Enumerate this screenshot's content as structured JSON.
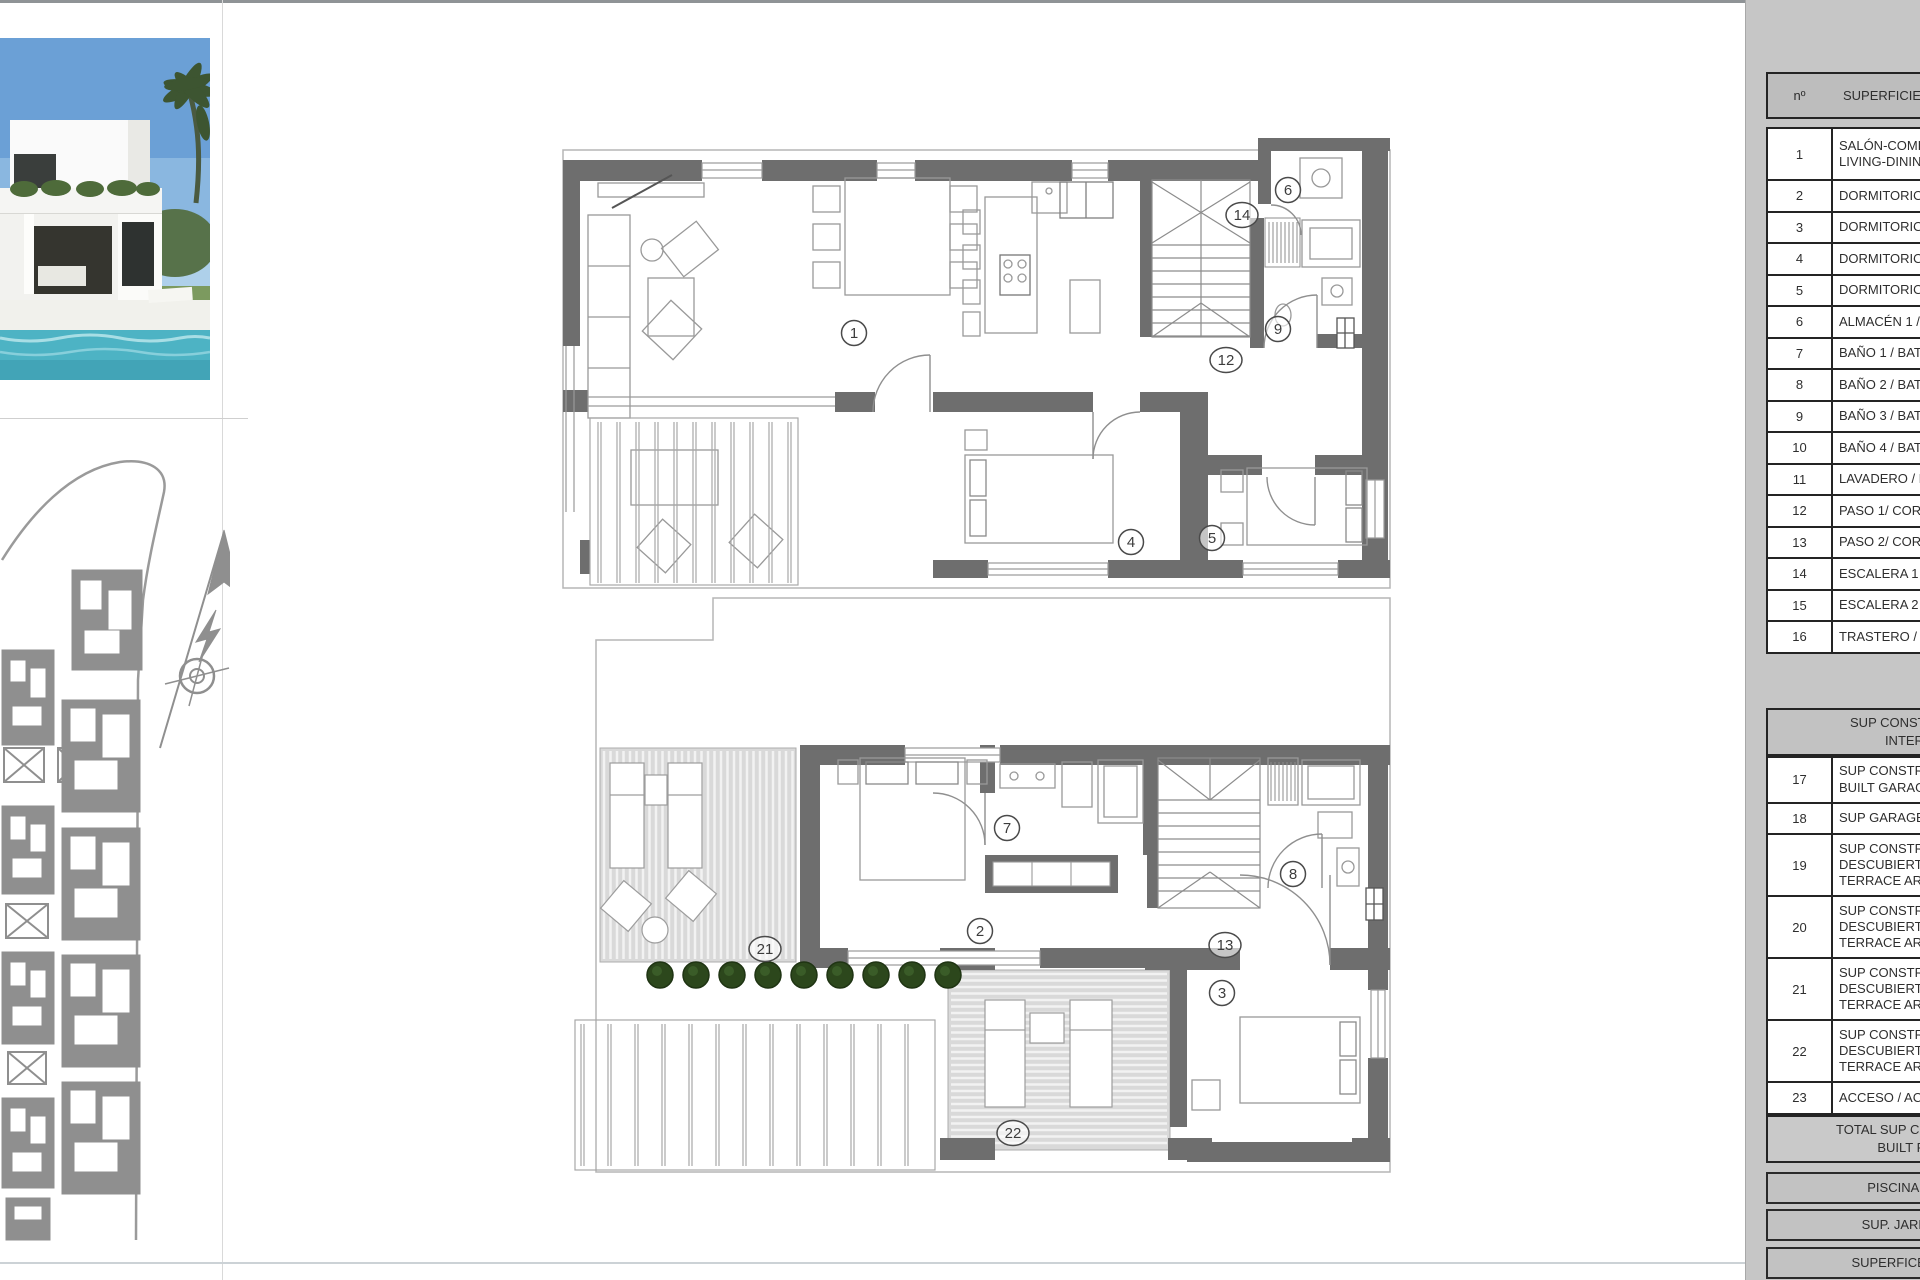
{
  "legend_table": {
    "panel_bg": "#c6c6c6",
    "header": {
      "col_no": "nº",
      "col_label": "SUPERFICIE Ú"
    },
    "rows": [
      {
        "no": "1",
        "lines": [
          "SALÓN-COME",
          "LIVING-DININ"
        ]
      },
      {
        "no": "2",
        "lines": [
          "DORMITORIO"
        ]
      },
      {
        "no": "3",
        "lines": [
          "DORMITORIO"
        ]
      },
      {
        "no": "4",
        "lines": [
          "DORMITORIO"
        ]
      },
      {
        "no": "5",
        "lines": [
          "DORMITORIO"
        ]
      },
      {
        "no": "6",
        "lines": [
          "ALMACÉN 1 /"
        ]
      },
      {
        "no": "7",
        "lines": [
          "BAÑO 1 / BAT"
        ]
      },
      {
        "no": "8",
        "lines": [
          "BAÑO 2 / BAT"
        ]
      },
      {
        "no": "9",
        "lines": [
          "BAÑO 3 / BAT"
        ]
      },
      {
        "no": "10",
        "lines": [
          "BAÑO 4 / BAT"
        ]
      },
      {
        "no": "11",
        "lines": [
          "LAVADERO / L"
        ]
      },
      {
        "no": "12",
        "lines": [
          "PASO 1/ CORR"
        ]
      },
      {
        "no": "13",
        "lines": [
          "PASO 2/ CORR"
        ]
      },
      {
        "no": "14",
        "lines": [
          "ESCALERA 1 /"
        ]
      },
      {
        "no": "15",
        "lines": [
          "ESCALERA 2 /"
        ]
      },
      {
        "no": "16",
        "lines": [
          "TRASTERO / S"
        ]
      }
    ],
    "section2_header_lines": [
      "SUP CONSTRUIDA IN",
      "INTERIOR"
    ],
    "rows2": [
      {
        "no": "17",
        "lines": [
          "SUP CONSTRU",
          "BUILT GARAG"
        ]
      },
      {
        "no": "18",
        "lines": [
          "SUP GARAGE/"
        ]
      },
      {
        "no": "19",
        "lines": [
          "SUP CONSTRU",
          "DESCUBIERTA",
          "TERRACE ARE"
        ]
      },
      {
        "no": "20",
        "lines": [
          "SUP CONSTRU",
          "DESCUBIERTA",
          "TERRACE ARE"
        ]
      },
      {
        "no": "21",
        "lines": [
          "SUP CONSTRU",
          "DESCUBIERTA",
          "TERRACE ARE"
        ]
      },
      {
        "no": "22",
        "lines": [
          "SUP CONSTRU",
          "DESCUBIERTA",
          "TERRACE ARE"
        ]
      },
      {
        "no": "23",
        "lines": [
          "ACCESO / ACC"
        ]
      }
    ],
    "total_lines": [
      "TOTAL SUP CONSTRUIDA",
      "BUILT PRIVA"
    ],
    "footer_rows": [
      "PISCINA / SWIM",
      "SUP. JARDÍN / GA",
      "SUPERFICE PARCEL"
    ]
  },
  "floor_plans": {
    "upper_rooms": [
      {
        "n": "1",
        "x": 854,
        "y": 333
      },
      {
        "n": "4",
        "x": 1131,
        "y": 542
      },
      {
        "n": "5",
        "x": 1212,
        "y": 538
      },
      {
        "n": "6",
        "x": 1288,
        "y": 190
      },
      {
        "n": "9",
        "x": 1278,
        "y": 329
      },
      {
        "n": "12",
        "x": 1226,
        "y": 360
      },
      {
        "n": "14",
        "x": 1242,
        "y": 215
      }
    ],
    "lower_rooms": [
      {
        "n": "2",
        "x": 980,
        "y": 931
      },
      {
        "n": "3",
        "x": 1222,
        "y": 993
      },
      {
        "n": "7",
        "x": 1007,
        "y": 828
      },
      {
        "n": "8",
        "x": 1293,
        "y": 874
      },
      {
        "n": "13",
        "x": 1225,
        "y": 945
      },
      {
        "n": "21",
        "x": 765,
        "y": 949
      },
      {
        "n": "22",
        "x": 1013,
        "y": 1133
      }
    ]
  },
  "colors": {
    "wall": "#6e6e6e",
    "thin": "#aaaaaa",
    "furniture": "#999999",
    "hatch_bg": "#d9d9d9",
    "hatch_line": "#f2f2f2",
    "bush": "#2c471c",
    "panel": "#c6c6c6",
    "pool": "#4db3c4"
  }
}
